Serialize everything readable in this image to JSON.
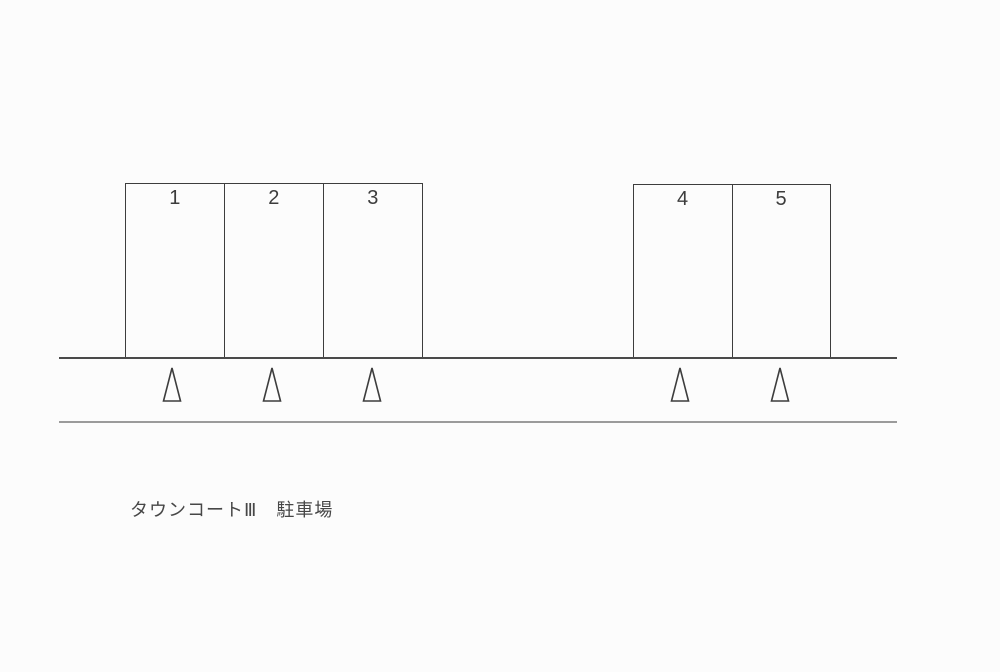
{
  "caption": {
    "text": "タウンコートⅢ　駐車場"
  },
  "parking": {
    "blocks": [
      {
        "name": "block-spaces-1-3",
        "spaces": [
          {
            "label": "1"
          },
          {
            "label": "2"
          },
          {
            "label": "3"
          }
        ]
      },
      {
        "name": "block-spaces-4-5",
        "spaces": [
          {
            "label": "4"
          },
          {
            "label": "5"
          }
        ]
      }
    ],
    "cone_markers": 5,
    "road_lines": 2
  },
  "colors": {
    "background": "#fcfcfc",
    "line": "#3d3d3d",
    "road_near_edge": "#4a4a4a",
    "road_far_edge": "#9b9b9b",
    "text": "#474747"
  }
}
